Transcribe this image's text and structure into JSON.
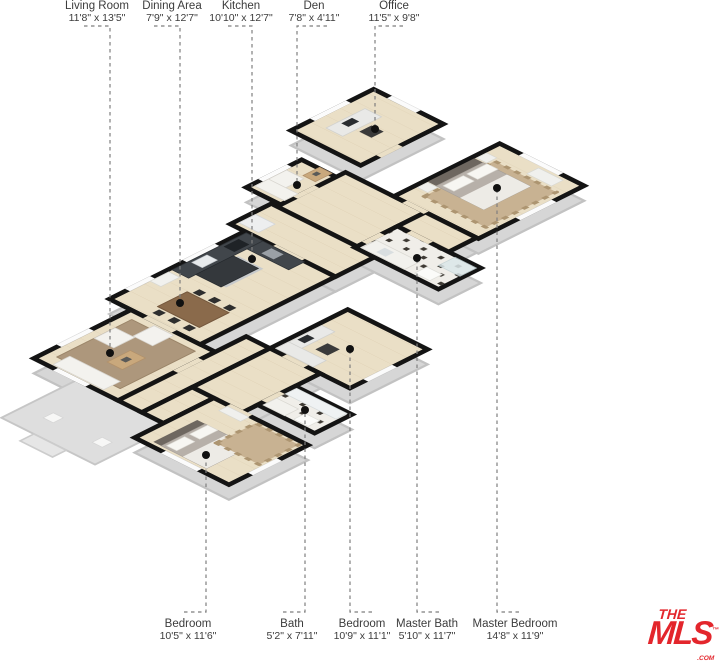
{
  "branding": {
    "the": "THE",
    "mls": "MLS",
    "tm": "™",
    "com": ".COM",
    "brand_color": "#E3262C"
  },
  "rooms": {
    "living_room": {
      "name": "Living Room",
      "dims": "11'8\" x 13'5\""
    },
    "dining_area": {
      "name": "Dining Area",
      "dims": "7'9\" x 12'7\""
    },
    "kitchen": {
      "name": "Kitchen",
      "dims": "10'10\" x 12'7\""
    },
    "den": {
      "name": "Den",
      "dims": "7'8\" x 4'11\""
    },
    "office": {
      "name": "Office",
      "dims": "11'5\" x 9'8\""
    },
    "bedroom_1": {
      "name": "Bedroom",
      "dims": "10'5\" x 11'6\""
    },
    "bath": {
      "name": "Bath",
      "dims": "5'2\" x 7'11\""
    },
    "bedroom_2": {
      "name": "Bedroom",
      "dims": "10'9\" x 11'1\""
    },
    "master_bath": {
      "name": "Master Bath",
      "dims": "5'10\" x 11'7\""
    },
    "master_bedroom": {
      "name": "Master Bedroom",
      "dims": "14'8\" x 11'9\""
    }
  },
  "colors": {
    "floor_wood": "#EADFC6",
    "bath_tile": "#F0EEE9",
    "wall_cap": "#141414",
    "rug_brown": "#AD977C",
    "rug_pattern": "#C8B292",
    "counter_dark": "#41464B",
    "leader_gray": "#7E7E7E",
    "brand_red": "#E3262C"
  }
}
